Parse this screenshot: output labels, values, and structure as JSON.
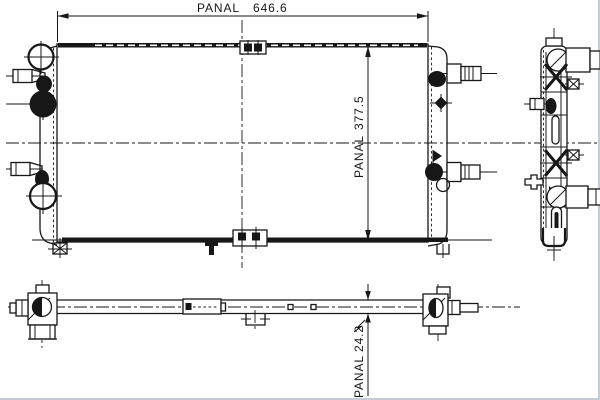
{
  "colors": {
    "ink": "#171717",
    "paper": "#ffffff",
    "edge_shadow": "#c6ccd2"
  },
  "dimensions": {
    "width": {
      "label": "PANAL",
      "value": "646.6"
    },
    "height": {
      "label": "PANAL",
      "value": "377.5"
    },
    "thickness": {
      "label": "PANAL",
      "value": "24.2"
    }
  }
}
